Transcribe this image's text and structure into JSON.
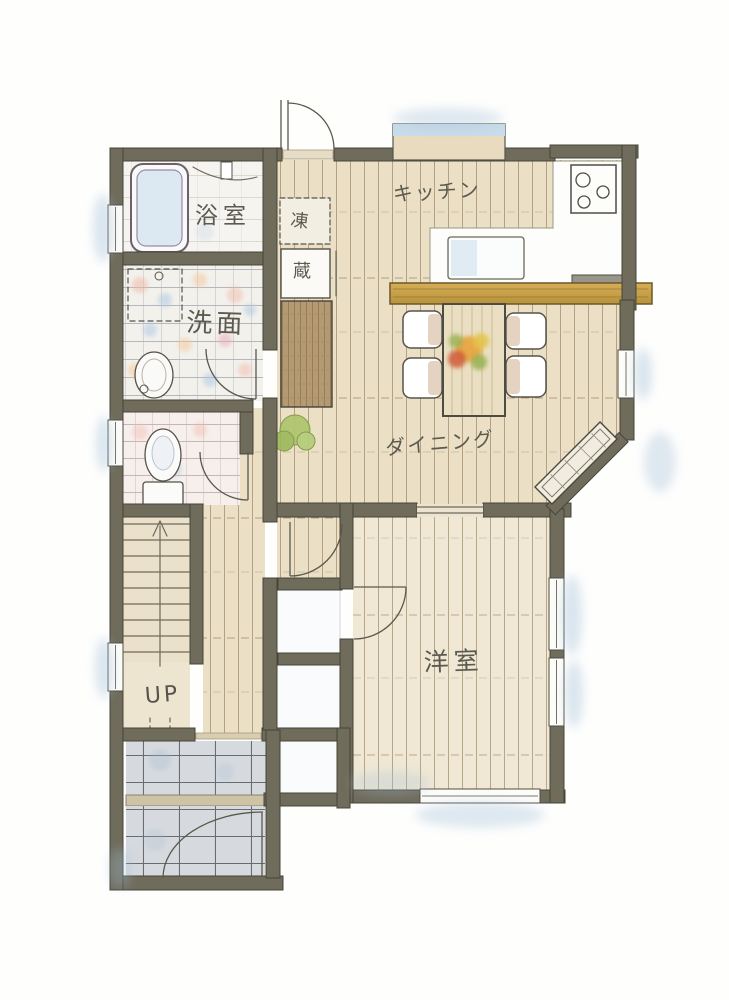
{
  "floorplan": {
    "title": "hand-drawn residential floor plan (first floor)",
    "rooms": {
      "bathroom": {
        "label": "浴室"
      },
      "washroom": {
        "label": "洗面"
      },
      "kitchen": {
        "label": "キッチン"
      },
      "dining": {
        "label": "ダイニング"
      },
      "western_room": {
        "label": "洋室"
      },
      "stairs": {
        "label": "UP"
      },
      "freezer_box": {
        "label": "凍"
      },
      "storage_box": {
        "label": "蔵"
      }
    },
    "palette": {
      "wall": "#6f6c5b",
      "ink": "#55534a",
      "wood_floor": "#ebe0c6",
      "room_floor": "#efe7d3",
      "tile_floor": "#f3f1ec",
      "entry_tile": "#d6dade",
      "counter_wood": "#c9a351",
      "cabinet_wood": "#b49a73",
      "watercolor_blue": "#a3c0da",
      "plant_green": "#a9c466",
      "flower_orange": "#e8a33c",
      "flower_red": "#cf5b36"
    }
  }
}
